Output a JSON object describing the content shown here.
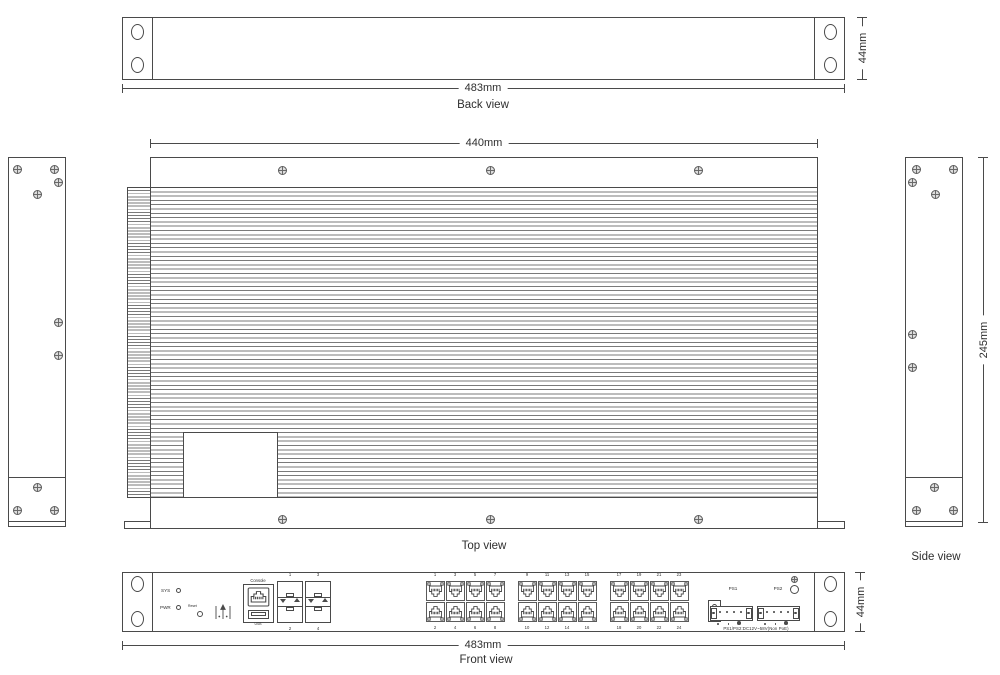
{
  "colors": {
    "line": "#4a4a4a",
    "text": "#2e2e2e",
    "background": "#ffffff",
    "screw_fill": "#dddddd"
  },
  "views": {
    "back": {
      "label": "Back view",
      "dim_width": "483mm",
      "dim_height": "44mm"
    },
    "top": {
      "label": "Top view",
      "dim_width": "440mm"
    },
    "side": {
      "label": "Side view",
      "dim_height": "245mm"
    },
    "front": {
      "label": "Front view",
      "dim_width": "483mm",
      "dim_height": "44mm",
      "led_sys": "SYS",
      "led_pwr": "PWR",
      "reset": "Reset",
      "console": "Console",
      "usb": "USB",
      "sfp": [
        {
          "top": "1",
          "bottom": "2"
        },
        {
          "top": "3",
          "bottom": "4"
        }
      ],
      "rj45_groups": [
        {
          "top": [
            "1",
            "3",
            "5",
            "7"
          ],
          "bottom": [
            "2",
            "4",
            "6",
            "8"
          ]
        },
        {
          "top": [
            "9",
            "11",
            "13",
            "15"
          ],
          "bottom": [
            "10",
            "12",
            "14",
            "16"
          ]
        },
        {
          "top": [
            "17",
            "19",
            "21",
            "23"
          ],
          "bottom": [
            "18",
            "20",
            "22",
            "24"
          ]
        }
      ],
      "ps1": "PS1",
      "ps2": "PS2",
      "power_spec": "PS1/PS2:DC12V~58V(Non PoE)"
    }
  },
  "icons": {
    "screw": "crosshead-screw",
    "mount_hole": "oval-slot",
    "up_arrows": "up-arrow-marks",
    "ground": "ground-stud",
    "sfp_triangles": "triangle-up-down"
  }
}
